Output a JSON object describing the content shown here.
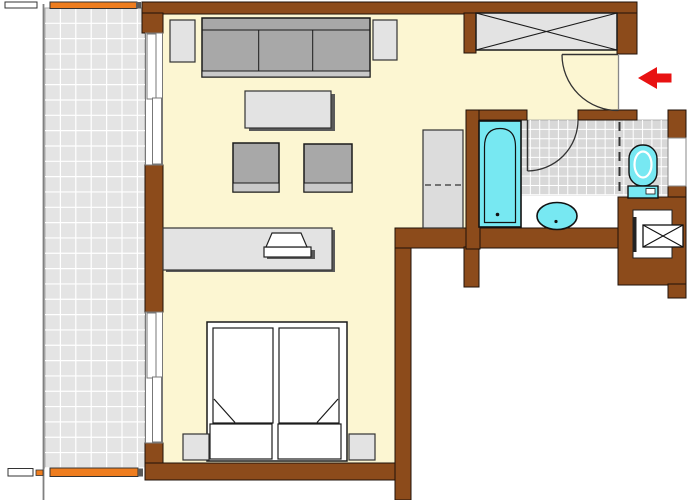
{
  "canvas": {
    "width": 700,
    "height": 500,
    "background": "#ffffff"
  },
  "palette": {
    "wall_brown": "#8C4B1B",
    "wall_outline": "#1F1208",
    "floor_cream": "#FCF6D2",
    "balcony_tile": "#E4E4E4",
    "bath_tile": "#D8D8D8",
    "tile_grout": "#FFFFFF",
    "furniture_light": "#E3E3E3",
    "cushion_gray": "#A8A8A8",
    "cushion_front": "#C9C9C9",
    "shadow_gray": "#5A5A5A",
    "fixture_cyan": "#77E8F2",
    "railing_orange": "#EE7D1F",
    "arrow_red": "#E81212",
    "line_dark": "#1A1A1A",
    "white": "#FFFFFF"
  },
  "shapes": [
    {
      "n": "balcony-floor",
      "k": "rect",
      "x": 45,
      "y": 8,
      "w": 100,
      "h": 460,
      "f": "#E4E4E4",
      "s": "#AAAAAA",
      "sw": 1
    },
    {
      "n": "balcony-tile-grid",
      "k": "grid",
      "x": 45,
      "y": 8,
      "w": 100,
      "h": 460,
      "sx": 15.4,
      "sy": 15.33,
      "s": "#FFFFFF",
      "sw": 1.2
    },
    {
      "n": "balcony-edge-line",
      "k": "line",
      "x1": 43.5,
      "y1": 4,
      "x2": 43.5,
      "y2": 500,
      "s": "#808080",
      "sw": 1.8
    },
    {
      "n": "railing-top-white-seg",
      "k": "rect",
      "x": 5,
      "y": 2,
      "w": 32,
      "h": 6,
      "f": "#FFFFFF",
      "s": "#333333",
      "sw": 1
    },
    {
      "n": "railing-top",
      "k": "rect",
      "x": 50,
      "y": 2,
      "w": 87,
      "h": 6.5,
      "f": "#EE7D1F",
      "s": "#333333",
      "sw": 1
    },
    {
      "n": "railing-top-end-post",
      "k": "rect",
      "x": 136,
      "y": 2,
      "w": 5,
      "h": 6.5,
      "f": "#5A5A5A"
    },
    {
      "n": "railing-bottom-white-seg",
      "k": "rect",
      "x": 8,
      "y": 468.5,
      "w": 25,
      "h": 7.5,
      "f": "#FFFFFF",
      "s": "#333333",
      "sw": 1
    },
    {
      "n": "railing-bottom-nub",
      "k": "rect",
      "x": 36,
      "y": 470,
      "w": 7,
      "h": 5.5,
      "f": "#EE7D1F",
      "s": "#333333",
      "sw": 0.8
    },
    {
      "n": "railing-bottom",
      "k": "rect",
      "x": 50,
      "y": 468,
      "w": 88,
      "h": 8.5,
      "f": "#EE7D1F",
      "s": "#333333",
      "sw": 1
    },
    {
      "n": "railing-bottom-end-post",
      "k": "rect",
      "x": 138,
      "y": 468.5,
      "w": 5,
      "h": 8,
      "f": "#5A5A5A"
    },
    {
      "n": "floor-living-room",
      "k": "rect",
      "x": 163,
      "y": 14,
      "w": 232,
      "h": 450,
      "f": "#FCF6D2"
    },
    {
      "n": "floor-hallway",
      "k": "rect",
      "x": 395,
      "y": 14,
      "w": 71,
      "h": 214,
      "f": "#FCF6D2"
    },
    {
      "n": "floor-entry-hall",
      "k": "rect",
      "x": 466,
      "y": 14,
      "w": 152,
      "h": 96,
      "f": "#FCF6D2"
    },
    {
      "n": "floor-bath-threshold",
      "k": "rect",
      "x": 527,
      "y": 110,
      "w": 51,
      "h": 10,
      "f": "#FCF6D2"
    },
    {
      "n": "floor-bathroom",
      "k": "rect",
      "x": 480,
      "y": 120,
      "w": 138,
      "h": 108,
      "f": "#FFFFFF"
    },
    {
      "n": "floor-wc",
      "k": "rect",
      "x": 618,
      "y": 110,
      "w": 50,
      "h": 87,
      "f": "#FFFFFF"
    },
    {
      "n": "bathroom-tiles",
      "k": "rect",
      "x": 521,
      "y": 120,
      "w": 147,
      "h": 75,
      "f": "#D8D8D8",
      "s": "#999999",
      "sw": 0.7
    },
    {
      "n": "bathroom-tile-grid",
      "k": "grid",
      "x": 521,
      "y": 120,
      "w": 147,
      "h": 75,
      "sx": 9.35,
      "sy": 9.35,
      "s": "#FFFFFF",
      "sw": 1
    },
    {
      "n": "wall-top",
      "k": "rect",
      "x": 142,
      "y": 2,
      "w": 495,
      "h": 12,
      "f": "#8C4B1B",
      "s": "#1F1208",
      "sw": 1
    },
    {
      "n": "wall-left-top-corner",
      "k": "rect",
      "x": 142,
      "y": 13,
      "w": 21,
      "h": 20,
      "f": "#8C4B1B",
      "s": "#1F1208",
      "sw": 1
    },
    {
      "n": "wall-left-middle",
      "k": "rect",
      "x": 145,
      "y": 165,
      "w": 18,
      "h": 147,
      "f": "#8C4B1B",
      "s": "#1F1208",
      "sw": 1
    },
    {
      "n": "wall-left-bottom-corner",
      "k": "rect",
      "x": 145,
      "y": 443,
      "w": 18,
      "h": 22,
      "f": "#8C4B1B",
      "s": "#1F1208",
      "sw": 1
    },
    {
      "n": "wall-bottom",
      "k": "rect",
      "x": 145,
      "y": 463,
      "w": 251,
      "h": 17,
      "f": "#8C4B1B",
      "s": "#1F1208",
      "sw": 1
    },
    {
      "n": "wall-bedroom-right",
      "k": "rect",
      "x": 395,
      "y": 247,
      "w": 16,
      "h": 253,
      "f": "#8C4B1B",
      "s": "#1F1208",
      "sw": 1
    },
    {
      "n": "wall-bathroom-bottom",
      "k": "rect",
      "x": 395,
      "y": 228,
      "w": 225,
      "h": 20,
      "f": "#8C4B1B",
      "s": "#1F1208",
      "sw": 1
    },
    {
      "n": "wall-hall-stub",
      "k": "rect",
      "x": 464,
      "y": 247,
      "w": 15,
      "h": 40,
      "f": "#8C4B1B",
      "s": "#1F1208",
      "sw": 1
    },
    {
      "n": "wall-bathroom-left",
      "k": "rect",
      "x": 466,
      "y": 110,
      "w": 14,
      "h": 139,
      "f": "#8C4B1B",
      "s": "#1F1208",
      "sw": 1
    },
    {
      "n": "wall-bathroom-top-left",
      "k": "rect",
      "x": 479,
      "y": 110,
      "w": 48,
      "h": 10,
      "f": "#8C4B1B",
      "s": "#1F1208",
      "sw": 1
    },
    {
      "n": "wall-bathroom-top-right",
      "k": "rect",
      "x": 578,
      "y": 110,
      "w": 59,
      "h": 10,
      "f": "#8C4B1B",
      "s": "#1F1208",
      "sw": 1
    },
    {
      "n": "wall-niche-stub",
      "k": "rect",
      "x": 464,
      "y": 13,
      "w": 12,
      "h": 40,
      "f": "#8C4B1B",
      "s": "#1F1208",
      "sw": 1
    },
    {
      "n": "wall-entry-right",
      "k": "rect",
      "x": 617,
      "y": 13,
      "w": 20,
      "h": 41,
      "f": "#8C4B1B",
      "s": "#1F1208",
      "sw": 1
    },
    {
      "n": "wall-wc-right",
      "k": "rect",
      "x": 668,
      "y": 110,
      "w": 18,
      "h": 87,
      "f": "#8C4B1B",
      "s": "#1F1208",
      "sw": 1
    },
    {
      "n": "wall-shaft-block",
      "k": "rect",
      "x": 618,
      "y": 197,
      "w": 68,
      "h": 88,
      "f": "#8C4B1B",
      "s": "#1F1208",
      "sw": 1
    },
    {
      "n": "wall-shaft-extension",
      "k": "rect",
      "x": 668,
      "y": 284,
      "w": 18,
      "h": 14,
      "f": "#8C4B1B",
      "s": "#1F1208",
      "sw": 1
    },
    {
      "n": "wc-window-inset",
      "k": "rect",
      "x": 668,
      "y": 138,
      "w": 18,
      "h": 48,
      "f": "#FFFFFF",
      "s": "#888888",
      "sw": 1
    },
    {
      "n": "window-top-frame",
      "k": "rect",
      "x": 145.5,
      "y": 33,
      "w": 17,
      "h": 132,
      "f": "#FFFFFF",
      "s": "#777777",
      "sw": 1
    },
    {
      "n": "window-top-panel-a",
      "k": "rect",
      "x": 147,
      "y": 34,
      "w": 9,
      "h": 65,
      "f": "#FFFFFF",
      "s": "#777777",
      "sw": 1
    },
    {
      "n": "window-top-panel-b",
      "k": "rect",
      "x": 152.5,
      "y": 98,
      "w": 9,
      "h": 66,
      "f": "#FFFFFF",
      "s": "#777777",
      "sw": 1
    },
    {
      "n": "window-bottom-frame",
      "k": "rect",
      "x": 145.5,
      "y": 312,
      "w": 17,
      "h": 131,
      "f": "#FFFFFF",
      "s": "#777777",
      "sw": 1
    },
    {
      "n": "window-bottom-panel-a",
      "k": "rect",
      "x": 147,
      "y": 313,
      "w": 9,
      "h": 65,
      "f": "#FFFFFF",
      "s": "#777777",
      "sw": 1
    },
    {
      "n": "window-bottom-panel-b",
      "k": "rect",
      "x": 152.5,
      "y": 377,
      "w": 9,
      "h": 65,
      "f": "#FFFFFF",
      "s": "#777777",
      "sw": 1
    },
    {
      "n": "side-table-left",
      "k": "rect",
      "x": 170,
      "y": 20,
      "w": 25,
      "h": 42,
      "f": "#E3E3E3",
      "s": "#333333",
      "sw": 1.2
    },
    {
      "n": "side-table-right",
      "k": "rect",
      "x": 373,
      "y": 20,
      "w": 24,
      "h": 40,
      "f": "#E3E3E3",
      "s": "#333333",
      "sw": 1.2
    },
    {
      "n": "sofa-body",
      "k": "rect",
      "x": 202,
      "y": 18,
      "w": 168,
      "h": 59,
      "f": "#A8A8A8",
      "s": "#1A1A1A",
      "sw": 1.5
    },
    {
      "n": "sofa-back-line",
      "k": "line",
      "x1": 202,
      "y1": 30,
      "x2": 370,
      "y2": 30,
      "s": "#1A1A1A",
      "sw": 1
    },
    {
      "n": "sofa-cushion-divider-1",
      "k": "line",
      "x1": 258.7,
      "y1": 30,
      "x2": 258.7,
      "y2": 71,
      "s": "#1A1A1A",
      "sw": 1
    },
    {
      "n": "sofa-cushion-divider-2",
      "k": "line",
      "x1": 312.7,
      "y1": 30,
      "x2": 312.7,
      "y2": 71,
      "s": "#1A1A1A",
      "sw": 1
    },
    {
      "n": "sofa-front-edge",
      "k": "rect",
      "x": 202,
      "y": 71,
      "w": 168,
      "h": 6,
      "f": "#C9C9C9",
      "s": "#1A1A1A",
      "sw": 1
    },
    {
      "n": "coffee-table-shadow",
      "k": "rect",
      "x": 249,
      "y": 94,
      "w": 86,
      "h": 37,
      "f": "#5A5A5A"
    },
    {
      "n": "coffee-table",
      "k": "rect",
      "x": 245,
      "y": 91,
      "w": 86,
      "h": 37,
      "f": "#E3E3E3",
      "s": "#333333",
      "sw": 1.2
    },
    {
      "n": "armchair-left",
      "k": "rect",
      "x": 233,
      "y": 143,
      "w": 46,
      "h": 49,
      "f": "#A8A8A8",
      "s": "#1A1A1A",
      "sw": 1.5
    },
    {
      "n": "armchair-left-front",
      "k": "rect",
      "x": 233,
      "y": 183,
      "w": 46,
      "h": 9,
      "f": "#C9C9C9",
      "s": "#1A1A1A",
      "sw": 1
    },
    {
      "n": "armchair-right",
      "k": "rect",
      "x": 304,
      "y": 144,
      "w": 48,
      "h": 48,
      "f": "#A8A8A8",
      "s": "#1A1A1A",
      "sw": 1.5
    },
    {
      "n": "armchair-right-front",
      "k": "rect",
      "x": 304,
      "y": 183,
      "w": 48,
      "h": 9,
      "f": "#C9C9C9",
      "s": "#1A1A1A",
      "sw": 1
    },
    {
      "n": "sideboard-shadow",
      "k": "rect",
      "x": 166,
      "y": 230,
      "w": 169,
      "h": 42,
      "f": "#5A5A5A"
    },
    {
      "n": "sideboard",
      "k": "rect",
      "x": 163,
      "y": 228,
      "w": 169,
      "h": 42,
      "f": "#E3E3E3",
      "s": "#333333",
      "sw": 1.2
    },
    {
      "n": "tv-shadow",
      "k": "rect",
      "x": 267,
      "y": 250,
      "w": 48,
      "h": 9,
      "f": "#5A5A5A"
    },
    {
      "n": "tv-base",
      "k": "rect",
      "x": 264,
      "y": 247,
      "w": 47,
      "h": 10,
      "f": "#FFFFFF",
      "s": "#222222",
      "sw": 1.2
    },
    {
      "n": "tv-screen",
      "k": "polygon",
      "p": "272,233 301,233 307,247 266,247",
      "f": "#FFFFFF",
      "s": "#222222",
      "sw": 1.2
    },
    {
      "n": "hall-wardrobe-cabinet",
      "k": "rect",
      "x": 423,
      "y": 130,
      "w": 40,
      "h": 98,
      "f": "#DCDCDC",
      "s": "#333333",
      "sw": 1.2
    },
    {
      "n": "hall-cabinet-rail-dash",
      "k": "line",
      "x1": 425,
      "y1": 185,
      "x2": 461,
      "y2": 185,
      "s": "#333333",
      "sw": 1.2,
      "d": "6,4"
    },
    {
      "n": "bed-frame",
      "k": "rect",
      "x": 207,
      "y": 322,
      "w": 140,
      "h": 139,
      "f": "#FFFFFF",
      "s": "#1A1A1A",
      "sw": 1.5
    },
    {
      "n": "mattress-left",
      "k": "rect",
      "x": 213,
      "y": 328,
      "w": 60,
      "h": 95,
      "f": "#FFFFFF",
      "s": "#1A1A1A",
      "sw": 1.2
    },
    {
      "n": "mattress-right",
      "k": "rect",
      "x": 279,
      "y": 328,
      "w": 60,
      "h": 95,
      "f": "#FFFFFF",
      "s": "#1A1A1A",
      "sw": 1.2
    },
    {
      "n": "mattress-left-fold",
      "k": "line",
      "x1": 214,
      "y1": 399,
      "x2": 235,
      "y2": 422.5,
      "s": "#1A1A1A",
      "sw": 1.2
    },
    {
      "n": "mattress-right-fold",
      "k": "line",
      "x1": 338,
      "y1": 399,
      "x2": 317,
      "y2": 422.5,
      "s": "#1A1A1A",
      "sw": 1.2
    },
    {
      "n": "pillow-left",
      "k": "rect",
      "x": 210,
      "y": 424,
      "w": 62,
      "h": 35,
      "f": "#FFFFFF",
      "s": "#1A1A1A",
      "sw": 1.2
    },
    {
      "n": "pillow-right",
      "k": "rect",
      "x": 278,
      "y": 424,
      "w": 63,
      "h": 35,
      "f": "#FFFFFF",
      "s": "#1A1A1A",
      "sw": 1.2
    },
    {
      "n": "nightstand-left",
      "k": "rect",
      "x": 183,
      "y": 434,
      "w": 26,
      "h": 26,
      "f": "#E3E3E3",
      "s": "#333333",
      "sw": 1.2
    },
    {
      "n": "nightstand-right",
      "k": "rect",
      "x": 349,
      "y": 434,
      "w": 26,
      "h": 26,
      "f": "#E3E3E3",
      "s": "#333333",
      "sw": 1.2
    },
    {
      "n": "entry-wardrobe",
      "k": "rect",
      "x": 476,
      "y": 13,
      "w": 141,
      "h": 37,
      "f": "#E3E3E3",
      "s": "#1A1A1A",
      "sw": 1.5
    },
    {
      "n": "entry-wardrobe-x",
      "k": "x",
      "x": 476,
      "y": 13,
      "w": 141,
      "h": 37,
      "s": "#1A1A1A",
      "sw": 1.1
    },
    {
      "n": "entry-threshold-line",
      "k": "line",
      "x1": 618.5,
      "y1": 54,
      "x2": 618.5,
      "y2": 110,
      "s": "#888888",
      "sw": 1.3
    },
    {
      "n": "entry-door-leaf",
      "k": "line",
      "x1": 562,
      "y1": 54.5,
      "x2": 618,
      "y2": 54.5,
      "s": "#333333",
      "sw": 1.5
    },
    {
      "n": "entry-door-swing-arc",
      "k": "path",
      "dd": "M562,54.5 A56,56 0 0 0 618.5,110.5",
      "s": "#333333",
      "sw": 1.3
    },
    {
      "n": "entrance-arrow",
      "k": "polygon",
      "p": "638,78 657,67 657,73.5 671.5,73.5 671.5,82.5 657,82.5 657,89",
      "f": "#E81212"
    },
    {
      "n": "bathroom-door-leaf",
      "k": "line",
      "x1": 527.5,
      "y1": 120,
      "x2": 527.5,
      "y2": 171,
      "s": "#333333",
      "sw": 1.5
    },
    {
      "n": "bathroom-door-swing-arc",
      "k": "path",
      "dd": "M578,120 A51,51 0 0 1 527.5,171",
      "s": "#333333",
      "sw": 1.3
    },
    {
      "n": "bathroom-wc-dashed-partition",
      "k": "line",
      "x1": 619.5,
      "y1": 122,
      "x2": 619.5,
      "y2": 194,
      "s": "#333333",
      "sw": 2,
      "d": "9,6"
    },
    {
      "n": "bathtub",
      "k": "rect",
      "x": 479,
      "y": 121,
      "w": 42,
      "h": 106,
      "f": "#77E8F2",
      "s": "#111111",
      "sw": 1.6
    },
    {
      "n": "bathtub-inner-outline",
      "k": "path",
      "dd": "M484.5,222.5 L484.5,147 Q484.5,128.5 500,128.5 Q515.5,128.5 515.5,147 L515.5,222.5 Z",
      "s": "#111111",
      "sw": 1.2
    },
    {
      "n": "bathtub-drain",
      "k": "circle",
      "cx": 497.5,
      "cy": 214.5,
      "r": 1.8,
      "f": "#111111"
    },
    {
      "n": "washbasin",
      "k": "ellipse",
      "cx": 557,
      "cy": 216,
      "rx": 20,
      "ry": 13.5,
      "f": "#77E8F2",
      "s": "#111111",
      "sw": 1.6
    },
    {
      "n": "washbasin-drain",
      "k": "circle",
      "cx": 556,
      "cy": 221.5,
      "r": 1.6,
      "f": "#111111"
    },
    {
      "n": "toilet-bowl",
      "k": "rect",
      "x": 629,
      "y": 145,
      "w": 28,
      "h": 41,
      "rx": 13.5,
      "f": "#77E8F2",
      "s": "#111111",
      "sw": 1.4
    },
    {
      "n": "toilet-rim",
      "k": "ellipse",
      "cx": 643,
      "cy": 164.5,
      "rx": 8.5,
      "ry": 13,
      "s": "#FFFFFF",
      "sw": 2.2
    },
    {
      "n": "toilet-tank",
      "k": "rect",
      "x": 628,
      "y": 186,
      "w": 30,
      "h": 12,
      "f": "#77E8F2",
      "s": "#111111",
      "sw": 1.4
    },
    {
      "n": "toilet-flush-handle",
      "k": "rect",
      "x": 646,
      "y": 188.5,
      "w": 9,
      "h": 5.5,
      "f": "#FFFFFF",
      "s": "#111111",
      "sw": 0.8
    },
    {
      "n": "shaft-room",
      "k": "rect",
      "x": 633,
      "y": 210,
      "w": 39,
      "h": 48,
      "f": "#FFFFFF",
      "s": "#222222",
      "sw": 1
    },
    {
      "n": "shaft-door-line",
      "k": "rect",
      "x": 633.5,
      "y": 217,
      "w": 3,
      "h": 35,
      "f": "#222222"
    },
    {
      "n": "shaft-duct-box",
      "k": "rect",
      "x": 643,
      "y": 225,
      "w": 40,
      "h": 22,
      "f": "#FFFFFF",
      "s": "#111111",
      "sw": 1.3
    },
    {
      "n": "shaft-duct-x",
      "k": "x",
      "x": 643,
      "y": 225,
      "w": 40,
      "h": 22,
      "s": "#111111",
      "sw": 1.1
    }
  ]
}
